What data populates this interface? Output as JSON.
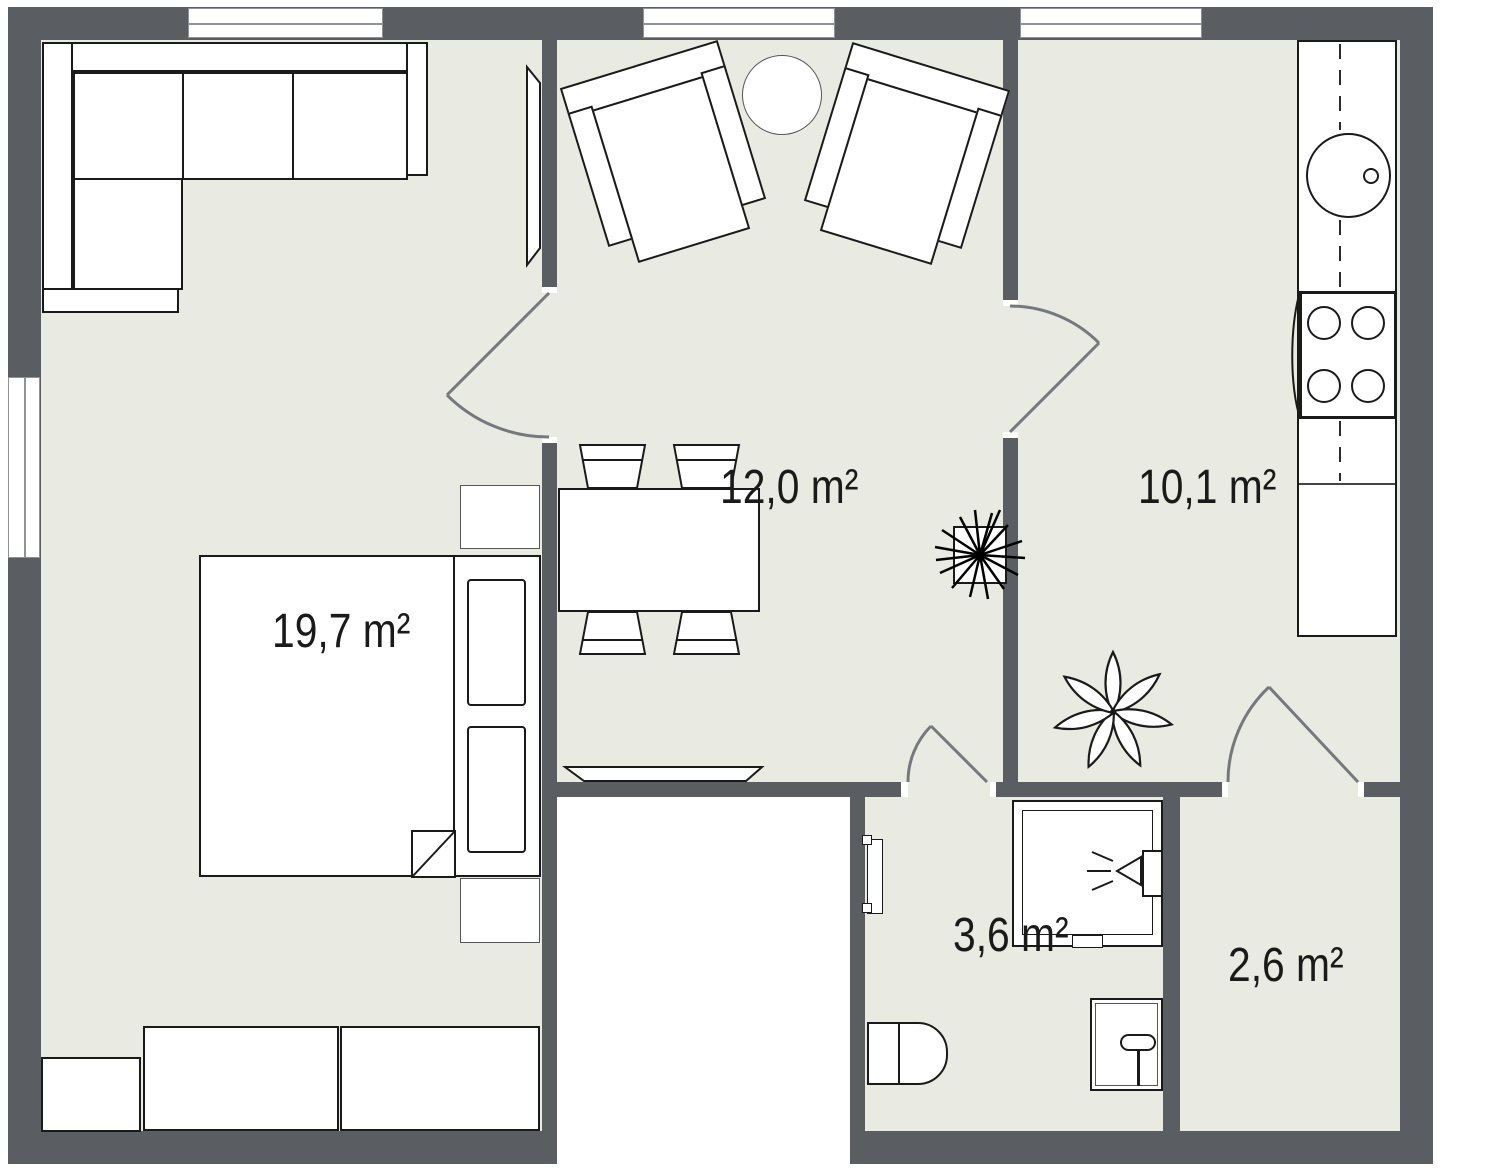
{
  "plan": {
    "type": "apartment floor plan",
    "area_unit": "m²",
    "rooms": [
      {
        "name": "living-bedroom",
        "area_label": "19,7 m²"
      },
      {
        "name": "dining-living",
        "area_label": "12,0 m²"
      },
      {
        "name": "kitchen",
        "area_label": "10,1 m²"
      },
      {
        "name": "bathroom",
        "area_label": "3,6 m²"
      },
      {
        "name": "hallway",
        "area_label": "2,6 m²"
      }
    ],
    "colors": {
      "wall": "#5a5e63",
      "floor": "#e9eae1",
      "outline": "#1a1a1a",
      "door_swing": "#75797d",
      "window_frame": "#8f9397"
    }
  }
}
